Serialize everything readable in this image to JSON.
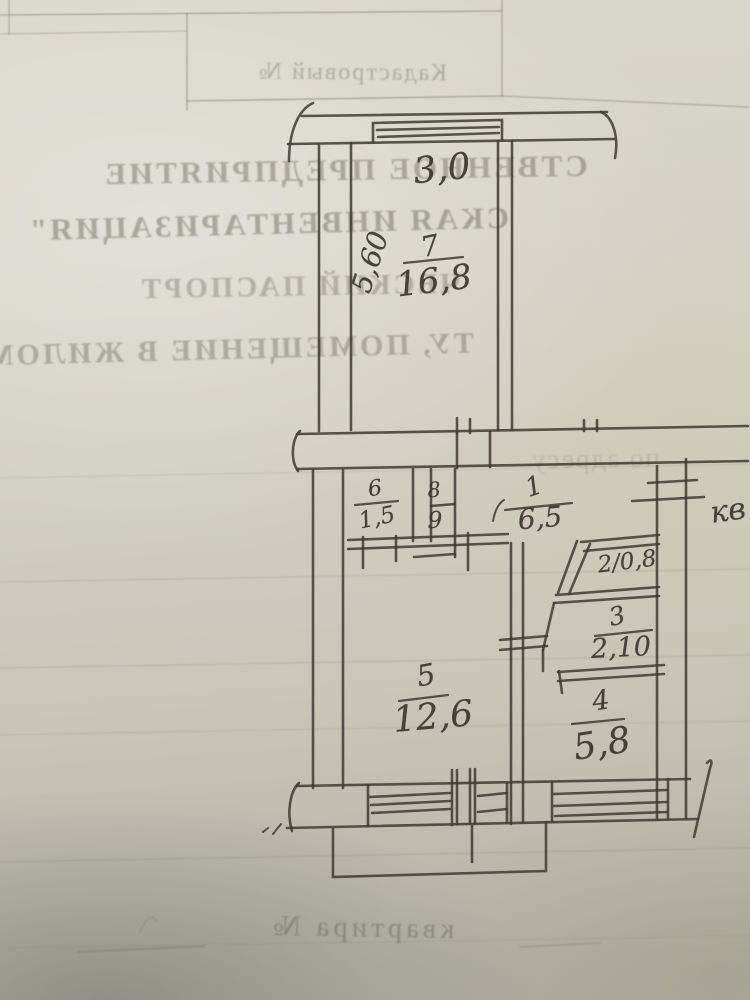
{
  "bleedthrough": {
    "cadastral_label": "Кадастровый №",
    "line1": "СТВЕННОЕ ПРЕДПРИЯТИЕ",
    "line2": "СКАЯ ИНВЕНТАРИЗАЦИЯ\"",
    "line3": "ЧЕСКИЙ ПАСПОРТ",
    "line4": "ТУ, ПОМЕЩЕНИЕ В ЖИЛОМ",
    "line5": "по адресу",
    "bottom_label": "квартира №"
  },
  "plan": {
    "balcony_width": "3,0",
    "room7_depth": "5,60",
    "margin_note": "кв",
    "rooms": {
      "r7": {
        "number": "7",
        "area": "16,8"
      },
      "r6": {
        "number": "6",
        "area": "1,5"
      },
      "r8": {
        "number": "8"
      },
      "r9": {
        "number": "9"
      },
      "r1": {
        "number": "1",
        "area": "6,5"
      },
      "r2": {
        "combined": "2/0,8"
      },
      "r3": {
        "number": "3",
        "area": "2,10"
      },
      "r5": {
        "number": "5",
        "area": "12,6"
      },
      "r4": {
        "number": "4",
        "area": "5,8"
      }
    }
  },
  "colors": {
    "ink": "#3e3b33",
    "paper": "#d3d0c5",
    "bleed_text": "#76715f"
  }
}
